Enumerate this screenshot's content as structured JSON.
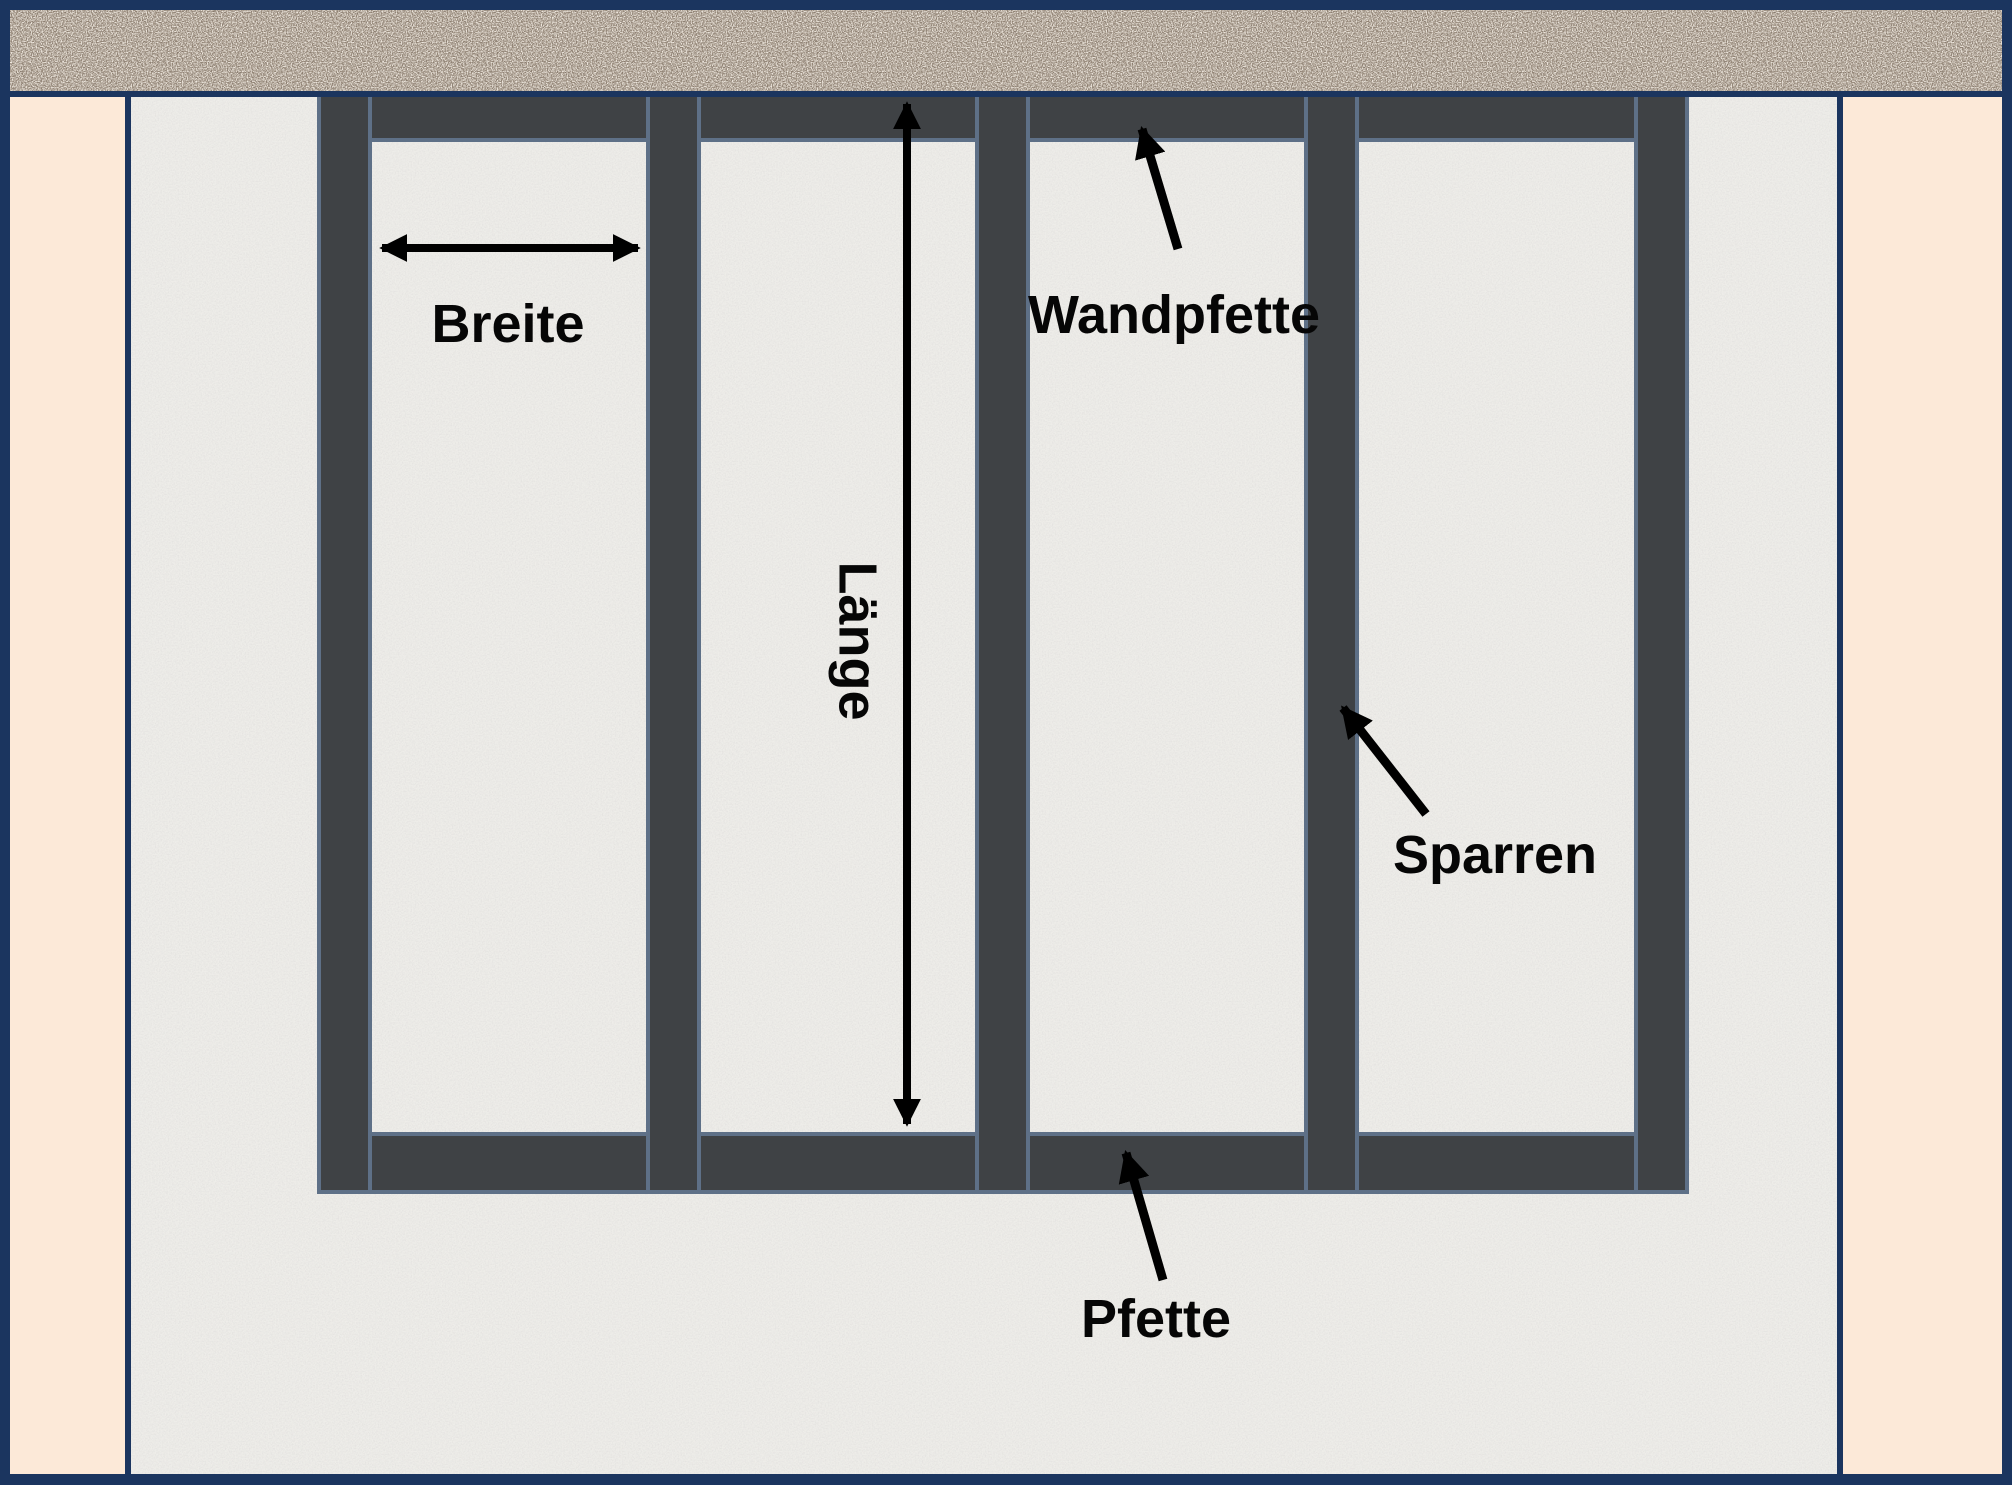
{
  "diagram": {
    "description": "Roof frame top view sketch with German construction terms",
    "labels": {
      "breite": "Breite",
      "laenge": "Länge",
      "wandpfette": "Wandpfette",
      "sparren": "Sparren",
      "pfette": "Pfette"
    },
    "colors": {
      "frame_navy": "#1b355f",
      "wall_brown": "#9a8c7c",
      "side_panel_peach": "#fce9d8",
      "ground_gray": "#eeede9",
      "beam_fill": "#3f4245",
      "beam_outline": "#5e7087",
      "annotation_black": "#000000"
    }
  }
}
